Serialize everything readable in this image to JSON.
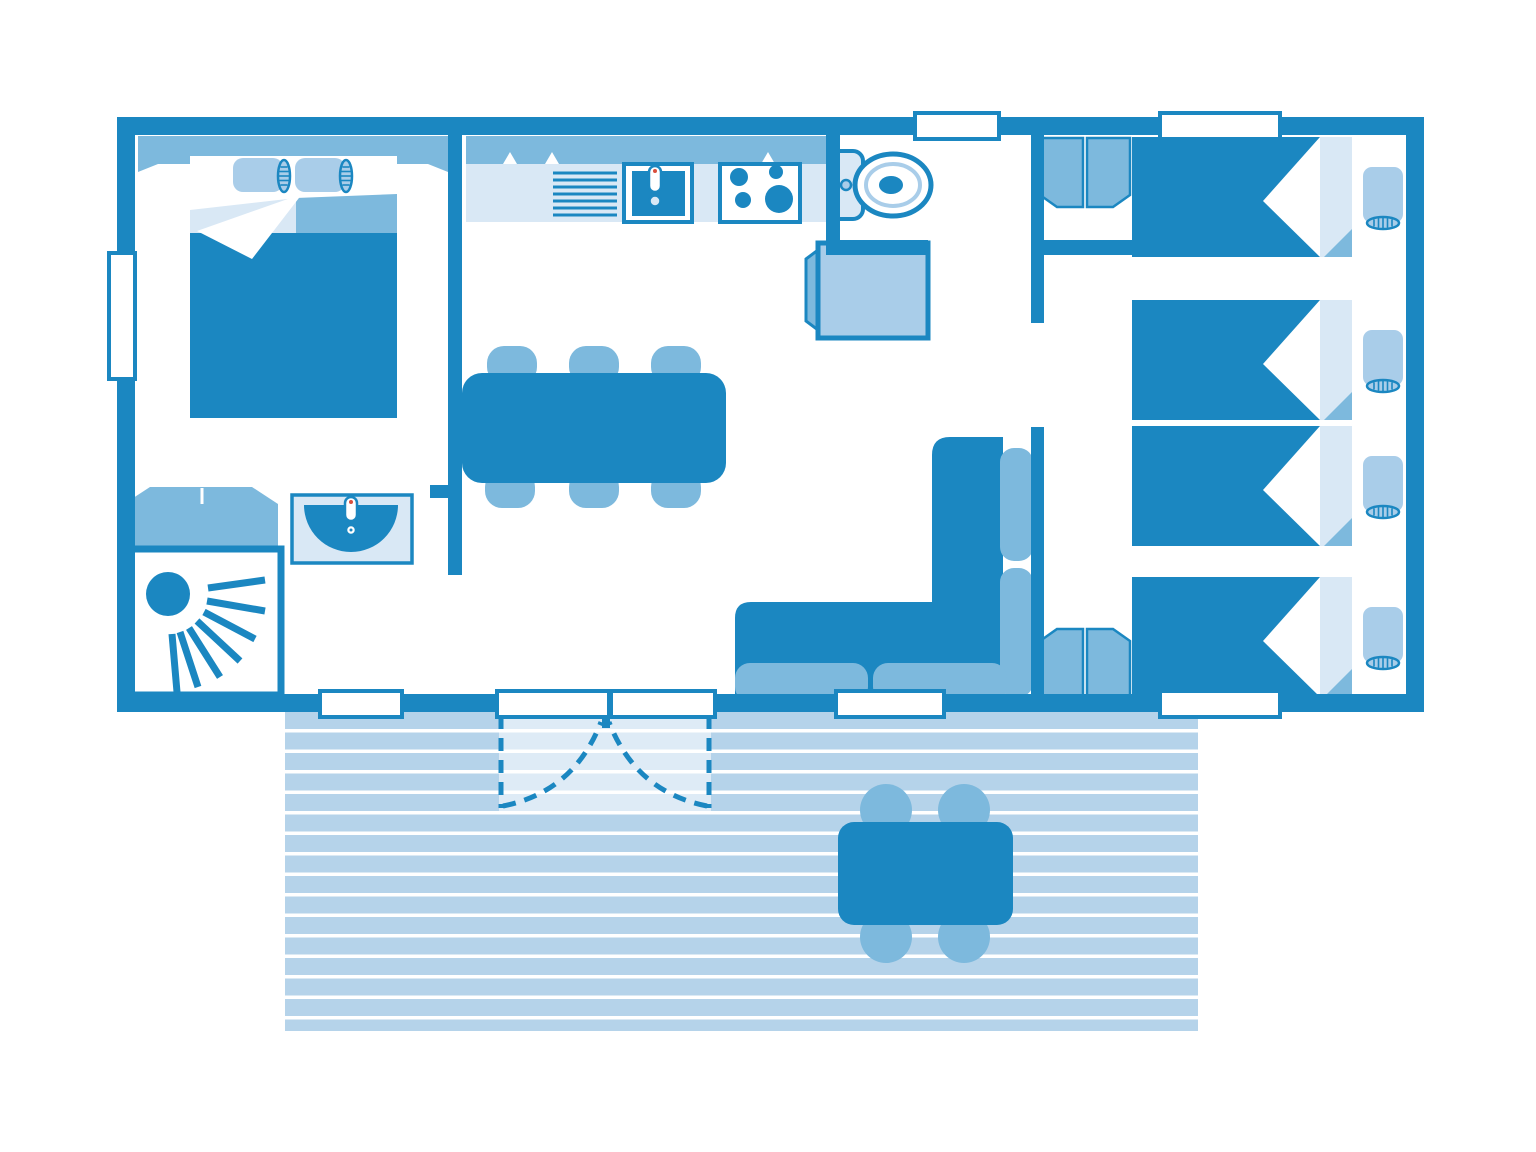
{
  "canvas": {
    "width": 1536,
    "height": 1152,
    "background": "#ffffff"
  },
  "palette": {
    "wall": "#1b87c1",
    "medium": "#7db9dd",
    "soft": "#a9cde9",
    "deck": "#b5d3ea",
    "light": "#d9e8f5",
    "accent": "#d94f3d"
  },
  "plan": {
    "type": "mobile-home floor plan, top view, monochrome blue",
    "rooms": [
      {
        "name": "master-bedroom",
        "fixtures": [
          "double-bed",
          "wardrobe",
          "small-wardrobe",
          "shower",
          "washbasin"
        ]
      },
      {
        "name": "kitchen-living",
        "fixtures": [
          "kitchen-counter",
          "draining-board",
          "sink",
          "stove",
          "dining-table",
          "six-chairs",
          "corner-sofa",
          "fridge"
        ]
      },
      {
        "name": "wc",
        "fixtures": [
          "toilet"
        ]
      },
      {
        "name": "bedroom-right-top",
        "fixtures": [
          "single-bed",
          "wardrobe"
        ]
      },
      {
        "name": "bedroom-right-middle",
        "fixtures": [
          "single-bed",
          "single-bed"
        ]
      },
      {
        "name": "bedroom-right-bottom",
        "fixtures": [
          "single-bed",
          "wardrobe"
        ]
      },
      {
        "name": "terrace",
        "fixtures": [
          "deck-boards",
          "outdoor-table",
          "four-chairs",
          "double-door-swing"
        ]
      }
    ],
    "openings": {
      "windows": 5,
      "french-doors": 2
    },
    "beds": {
      "double": 1,
      "single": 4
    }
  }
}
